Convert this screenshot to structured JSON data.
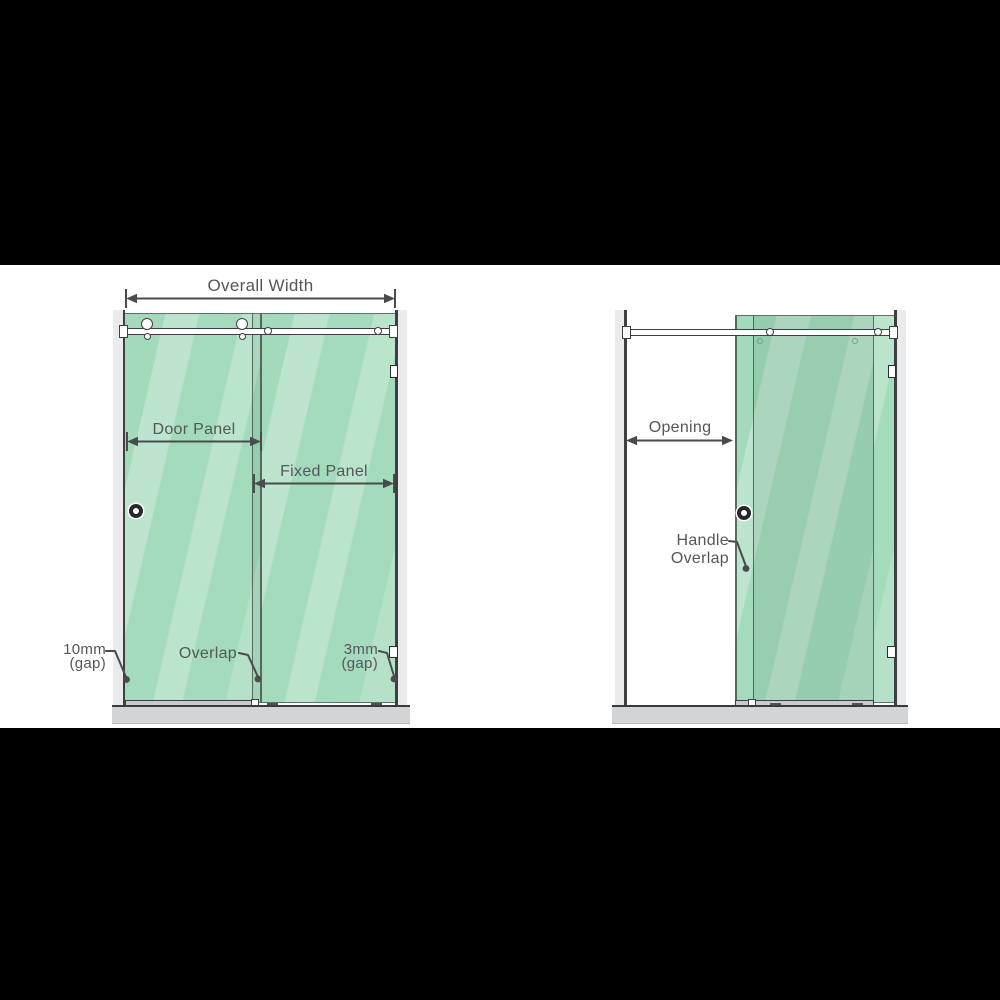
{
  "left_diagram": {
    "overall_width": "Overall Width",
    "door_panel": "Door Panel",
    "fixed_panel": "Fixed Panel",
    "gap_left": {
      "line1": "10mm",
      "line2": "(gap)"
    },
    "overlap": "Overlap",
    "gap_right": {
      "line1": "3mm",
      "line2": "(gap)"
    }
  },
  "right_diagram": {
    "opening": "Opening",
    "handle_overlap": {
      "line1": "Handle",
      "line2": "Overlap"
    }
  },
  "colors": {
    "glass_green": "#9fd9b9",
    "glass_overlap_shade": "#8fceab",
    "wall_gray": "#eaebed",
    "base_gray": "#d3d4d6",
    "hardware_line": "#3e3f41",
    "annotation_line": "#4a4b4d",
    "text_gray": "#55565b",
    "letterbox": "#000000",
    "canvas": "#ffffff"
  }
}
